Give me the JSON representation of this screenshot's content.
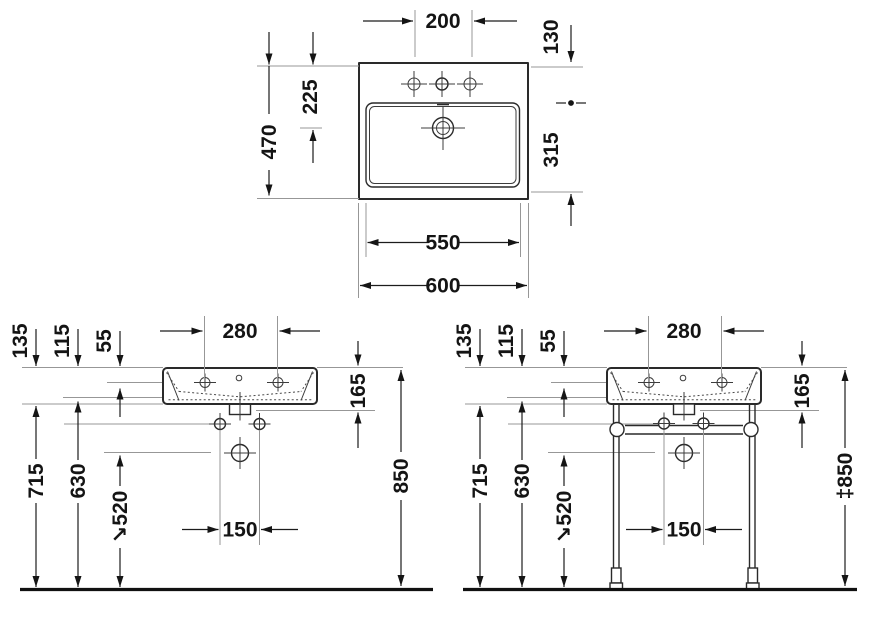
{
  "drawing_type": "washbasin dimensional technical drawing",
  "views": {
    "plan": {
      "labels": {
        "tap_hole_spacing": "200",
        "rear_to_ref": "130",
        "overall_depth": "470",
        "rear_to_drain": "225",
        "ref_to_front": "315",
        "bowl_width": "550",
        "overall_width": "600"
      }
    },
    "wall_mounted": {
      "labels": {
        "tap_spacing": "280",
        "rim_to_bottom": "135",
        "rim_to_bowl": "115",
        "rim_to_tap": "55",
        "rim_to_outlet": "165",
        "floor_to_bottom": "715",
        "floor_to_fixing": "630",
        "floor_to_trap": "↘520",
        "fixing_hole_spacing": "150",
        "rim_height": "850"
      }
    },
    "console": {
      "labels": {
        "tap_spacing": "280",
        "rim_to_bottom": "135",
        "rim_to_bowl": "115",
        "rim_to_tap": "55",
        "rim_to_outlet": "165",
        "floor_to_bottom": "715",
        "floor_to_fixing": "630",
        "floor_to_trap": "↘520",
        "fixing_hole_spacing": "150",
        "rim_height": "‡850"
      }
    }
  }
}
